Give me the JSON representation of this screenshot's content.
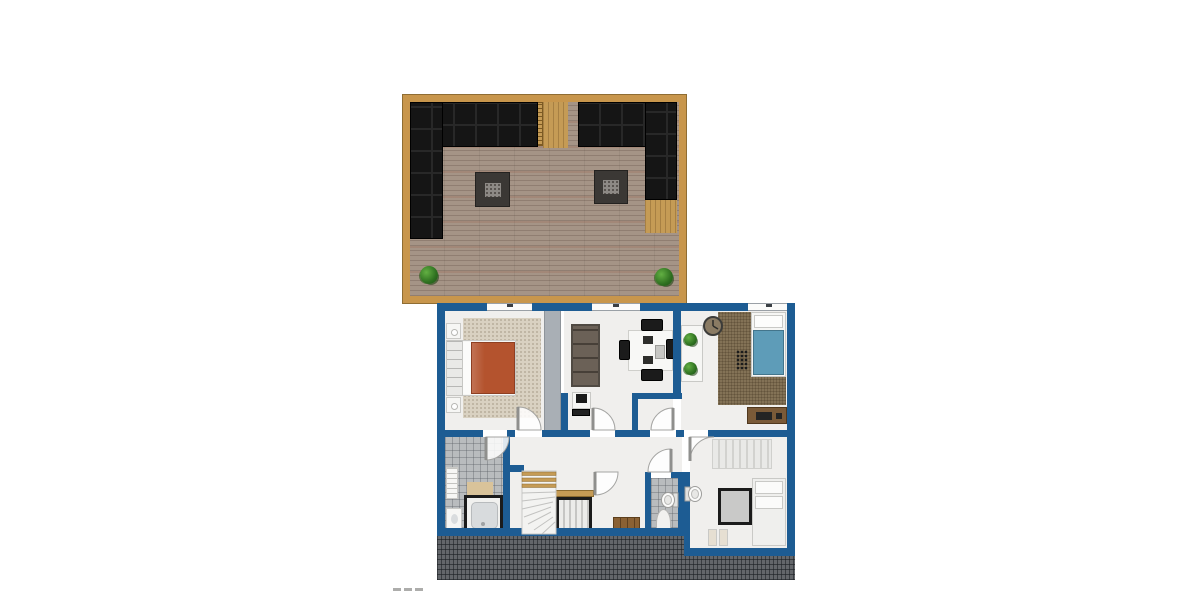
{
  "document": {
    "kind": "architectural-floor-plan",
    "floor": "attic level with roof terrace",
    "visible_text": "",
    "watermark_mark": "---"
  },
  "colors": {
    "wall": "#1d5c93",
    "floor": "#f0efed",
    "deckFrame": "#c8964c",
    "deckPlank": "#a59486",
    "sofaBlack": "#151515",
    "tableDark": "#3b3835",
    "plantGreen": "#3f8f2f",
    "rugBeige": "#d9d1c1",
    "duvetOrange": "#b4532e",
    "duvetBlue": "#5e9cb8",
    "carpetBrown": "#8c7a5d",
    "tileGray": "#b9bcbe",
    "roofHatch": "#63666a",
    "woodAccent": "#c59b55",
    "frameBlack": "#1b1b1b",
    "livingSofa": "#6b6157",
    "dresserWood": "#7a5a38",
    "grayStrip": "#a9afb5",
    "benchWood": "#8a6134",
    "matTan": "#d9c39a"
  },
  "terrace": {
    "id": "roof-terrace",
    "items": [
      "corner-sofa-left",
      "corner-sofa-right",
      "coffee-table-left",
      "coffee-table-right",
      "planter-left",
      "planter-right",
      "ladder",
      "deck-walkway",
      "wood-corner-patch"
    ]
  },
  "floorplan": {
    "rooms": [
      {
        "id": "bedroom-left",
        "items": [
          "double-bed-orange",
          "headboard",
          "nightstand-top",
          "nightstand-bottom",
          "area-rug",
          "window",
          "door"
        ]
      },
      {
        "id": "living-dining",
        "items": [
          "sofa",
          "dining-table",
          "chairs-4",
          "desk-with-pc",
          "window",
          "door"
        ]
      },
      {
        "id": "bedroom-right",
        "items": [
          "single-bed-blue",
          "wall-clock",
          "carpet",
          "plant-shelf",
          "plants-2",
          "dresser",
          "window",
          "entry-door"
        ]
      },
      {
        "id": "bathroom",
        "items": [
          "bathtub-under-skylight",
          "hand-sink",
          "radiator",
          "bath-mat",
          "door"
        ]
      },
      {
        "id": "hallway",
        "items": [
          "winder-staircase",
          "skylight-over-stairs",
          "wood-landing-strip",
          "wood-bench",
          "doors"
        ]
      },
      {
        "id": "wc",
        "items": [
          "wall-toilet",
          "alcove",
          "door"
        ]
      },
      {
        "id": "room-bottom-right",
        "items": [
          "daybed",
          "skylight",
          "wall-sink",
          "stools-2",
          "striped-rug",
          "door"
        ]
      }
    ]
  }
}
